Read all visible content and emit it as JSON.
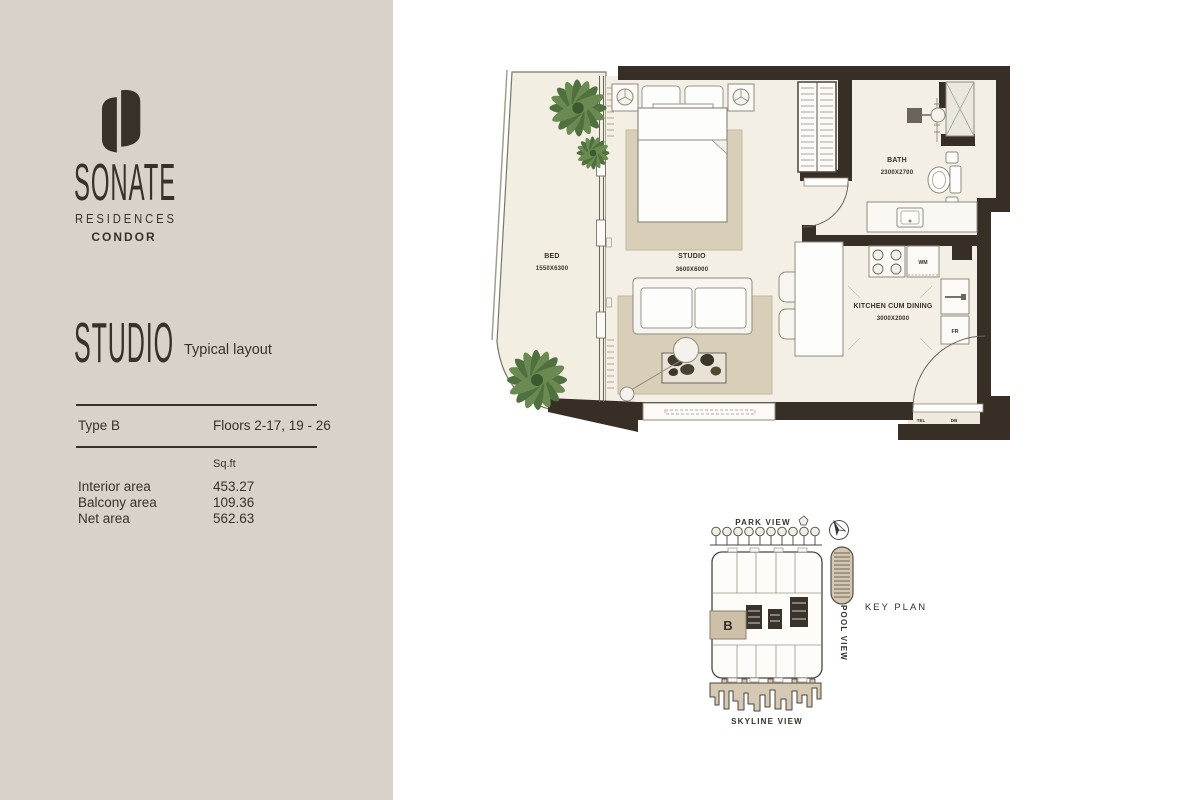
{
  "brand": {
    "name": "SONATE",
    "subtitle": "RESIDENCES",
    "tagline": "CONDOR"
  },
  "unit": {
    "title": "STUDIO",
    "subtitle": "Typical layout",
    "type_label": "Type B",
    "floors_label": "Floors 2-17, 19 - 26"
  },
  "areas": {
    "unit_header": "Sq.ft",
    "rows": [
      {
        "label": "Interior area",
        "value": "453.27"
      },
      {
        "label": "Balcony area",
        "value": "109.36"
      },
      {
        "label": "Net area",
        "value": "562.63"
      }
    ]
  },
  "floorplan": {
    "balcony_name": "BED",
    "balcony_dims": "1550X6300",
    "studio_name": "STUDIO",
    "studio_dims": "3600X6000",
    "bath_name": "BATH",
    "bath_dims": "2300X2700",
    "kitchen_name": "KITCHEN CUM DINING",
    "kitchen_dims": "3000X2000",
    "wm": "WM",
    "fr": "FR",
    "tel": "TEL",
    "db": "DB"
  },
  "keyplan": {
    "title": "KEY PLAN",
    "park_view": "PARK VIEW",
    "pool_view": "POOL VIEW",
    "skyline_view": "SKYLINE VIEW",
    "unit_marker": "B"
  },
  "colors": {
    "sidebar_bg": "#d9d2c8",
    "ink": "#383127",
    "wall": "#372f26",
    "floor": "#f4efe4",
    "rug": "#d9cfb9",
    "tree_green": "#50713f",
    "marker_red": "#c23b2e",
    "keyplan_unit": "#cdbfa8"
  }
}
